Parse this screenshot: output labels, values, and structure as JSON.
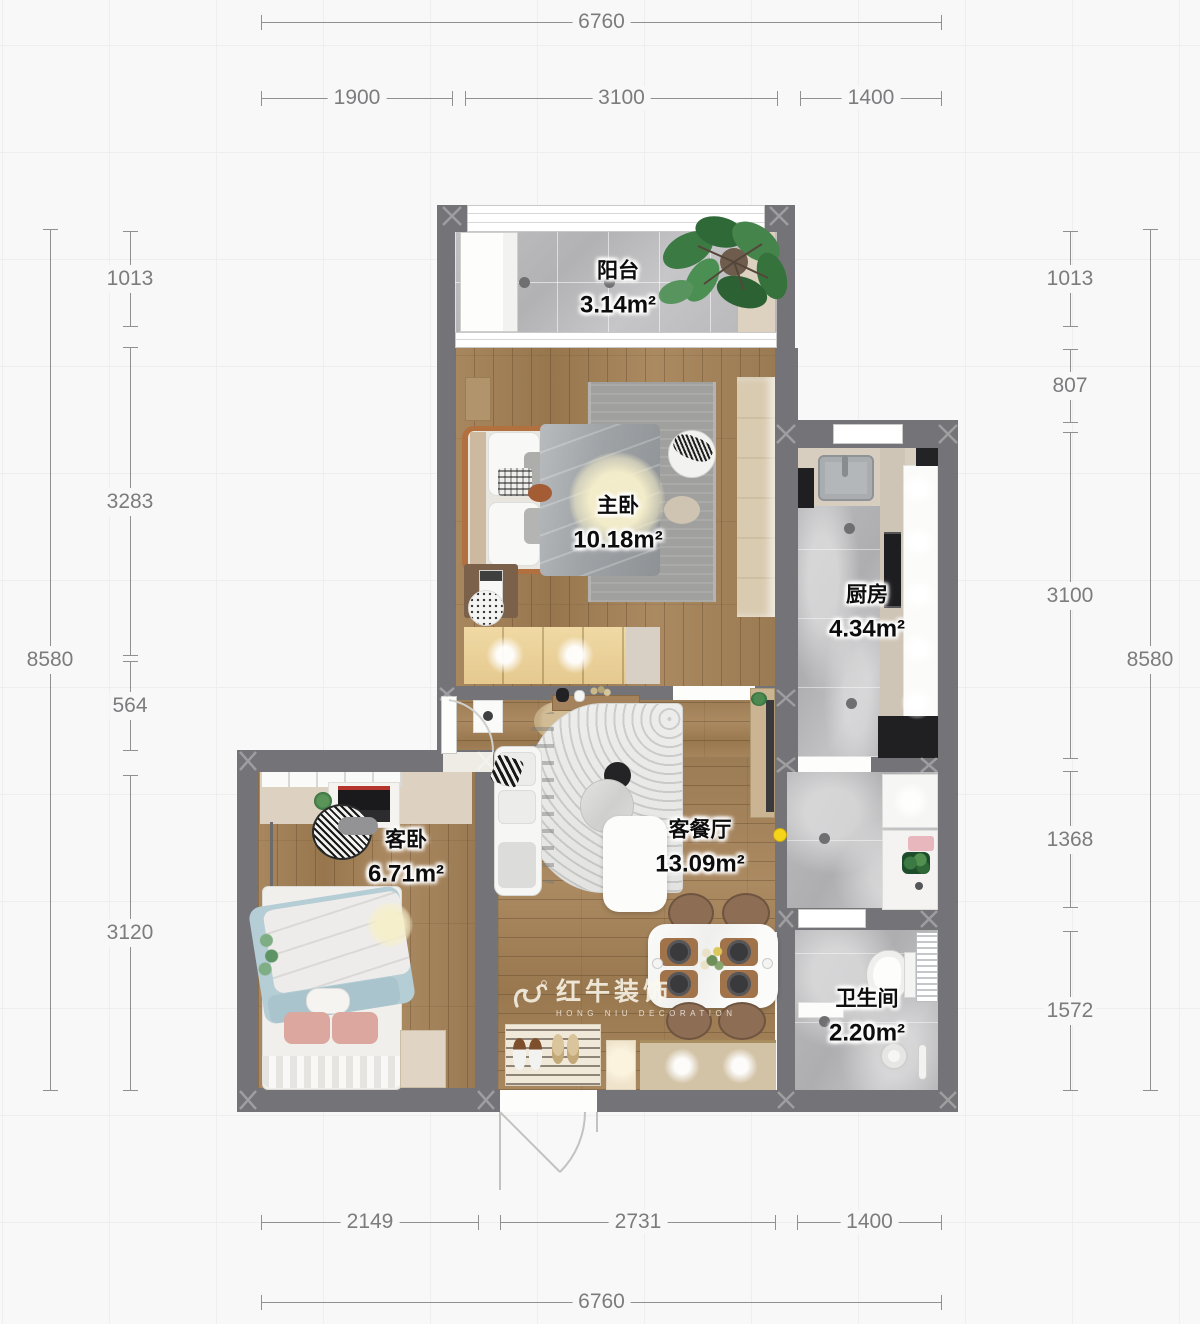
{
  "rooms": {
    "balcony": {
      "name": "阳台",
      "area": "3.14m²"
    },
    "master": {
      "name": "主卧",
      "area": "10.18m²"
    },
    "kitchen": {
      "name": "厨房",
      "area": "4.34m²"
    },
    "guest": {
      "name": "客卧",
      "area": "6.71m²"
    },
    "living": {
      "name": "客餐厅",
      "area": "13.09m²"
    },
    "bathroom": {
      "name": "卫生间",
      "area": "2.20m²"
    }
  },
  "dims": {
    "top": {
      "total": "6760",
      "segments": [
        "1900",
        "3100",
        "1400"
      ]
    },
    "bottom": {
      "total": "6760",
      "segments": [
        "2149",
        "2731",
        "1400"
      ]
    },
    "left": {
      "outer": "8580",
      "segments": [
        "1013",
        "3283",
        "564",
        "3120"
      ]
    },
    "right": {
      "outer": "8580",
      "segments": [
        "1013",
        "807",
        "3100",
        "1368",
        "1572"
      ]
    }
  },
  "watermark": {
    "brand": "红牛装饰",
    "reg": "®",
    "subtitle": "HONG NIU DECORATION"
  },
  "palette": {
    "wall": "#747478",
    "wood": "#a5835c",
    "tile": "#bcbcbe",
    "accent_dot": "#f5d312",
    "glow": "#f6efcb",
    "dim_text": "#7c7c7e"
  }
}
